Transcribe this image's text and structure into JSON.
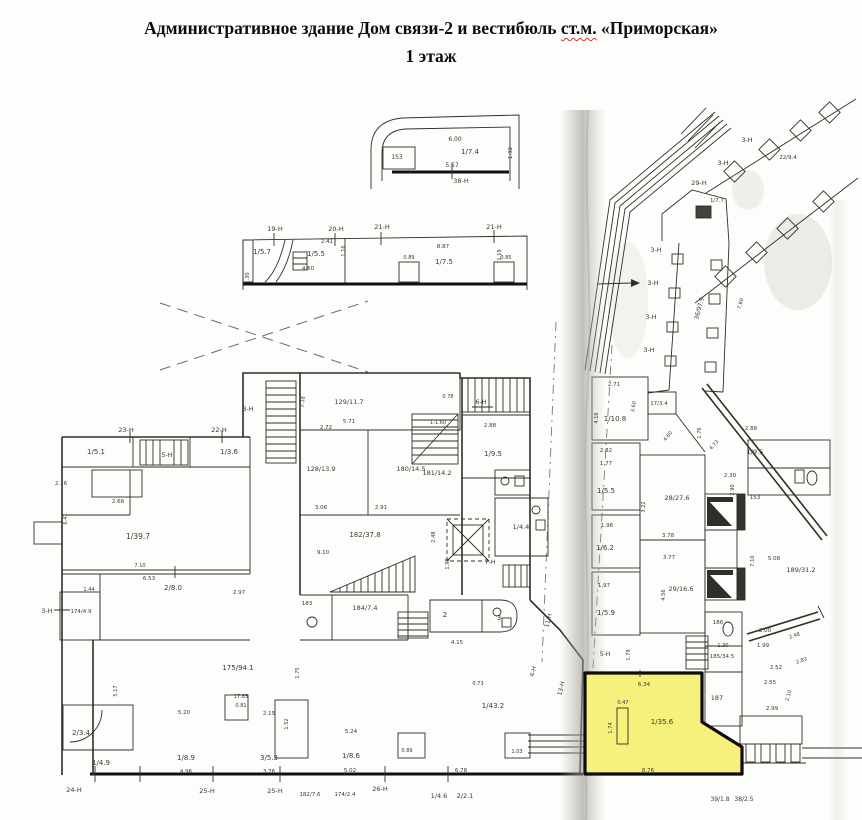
{
  "title": {
    "line1_pre": "Административное здание Дом связи-2 и вестибюль ",
    "line1_stm": "ст.м.",
    "line1_post": " «Приморская»",
    "line2": "1 этаж"
  },
  "colors": {
    "highlight": "#f7f07c",
    "ink": "#2f2e2a",
    "fold": "#aaa79f",
    "spell_underline": "#c4372e",
    "paper": "#fdfdfb"
  },
  "plan": {
    "highlight_room": {
      "room_label": "1/35.6",
      "top_dim": "6.34",
      "bottom_dim": "8.76"
    },
    "labels": [
      {
        "t": "6.00",
        "x": 455,
        "y": 141,
        "s": 6
      },
      {
        "t": "153",
        "x": 397,
        "y": 159,
        "s": 6
      },
      {
        "t": "1/7.4",
        "x": 470,
        "y": 154,
        "s": 7
      },
      {
        "t": "5.57",
        "x": 452,
        "y": 167,
        "s": 6
      },
      {
        "t": "38-Н",
        "x": 461,
        "y": 183,
        "s": 6.5
      },
      {
        "t": "1.92",
        "x": 512,
        "y": 153,
        "r": -90,
        "s": 5.5
      },
      {
        "t": "19-Н",
        "x": 275,
        "y": 231,
        "s": 6.5
      },
      {
        "t": "20-Н",
        "x": 336,
        "y": 231,
        "s": 6.5
      },
      {
        "t": "21-Н",
        "x": 382,
        "y": 229,
        "s": 6.5
      },
      {
        "t": "21-Н",
        "x": 494,
        "y": 229,
        "s": 6.5
      },
      {
        "t": "1/5.7",
        "x": 262,
        "y": 254,
        "s": 7
      },
      {
        "t": "2.41",
        "x": 327,
        "y": 243,
        "s": 5.5
      },
      {
        "t": "1/5.5",
        "x": 316,
        "y": 256,
        "s": 7
      },
      {
        "t": "1.16",
        "x": 345,
        "y": 251,
        "r": -90,
        "s": 5
      },
      {
        "t": "4.60",
        "x": 308,
        "y": 270,
        "s": 5.5
      },
      {
        "t": "1.30",
        "x": 249,
        "y": 278,
        "r": -90,
        "s": 5
      },
      {
        "t": "8.87",
        "x": 443,
        "y": 248,
        "s": 5.5
      },
      {
        "t": "1/7.5",
        "x": 444,
        "y": 264,
        "s": 7
      },
      {
        "t": "0.89",
        "x": 409,
        "y": 259,
        "s": 5
      },
      {
        "t": "0.85",
        "x": 506,
        "y": 259,
        "s": 5
      },
      {
        "t": "1.19",
        "x": 501,
        "y": 255,
        "r": -90,
        "s": 5
      },
      {
        "t": "23-Н",
        "x": 126,
        "y": 432,
        "s": 6.5
      },
      {
        "t": "22-Н",
        "x": 219,
        "y": 432,
        "s": 6.5
      },
      {
        "t": "1/5.1",
        "x": 96,
        "y": 454,
        "s": 7
      },
      {
        "t": "5-Н",
        "x": 167,
        "y": 457,
        "s": 6.5
      },
      {
        "t": "1/3.6",
        "x": 229,
        "y": 454,
        "s": 7
      },
      {
        "t": "2.16",
        "x": 61,
        "y": 485,
        "s": 5.5
      },
      {
        "t": "2.66",
        "x": 118,
        "y": 503,
        "s": 5.5
      },
      {
        "t": "6.41",
        "x": 67,
        "y": 519,
        "r": -90,
        "s": 5
      },
      {
        "t": "1/39.7",
        "x": 138,
        "y": 539,
        "s": 7.5
      },
      {
        "t": "7.10",
        "x": 140,
        "y": 567,
        "s": 5
      },
      {
        "t": "6.53",
        "x": 149,
        "y": 580,
        "s": 5.5
      },
      {
        "t": "1.44",
        "x": 89,
        "y": 591,
        "s": 5
      },
      {
        "t": "2/8.0",
        "x": 173,
        "y": 590,
        "s": 7
      },
      {
        "t": "174/4.9",
        "x": 81,
        "y": 613,
        "s": 5.5
      },
      {
        "t": "3-Н",
        "x": 47,
        "y": 613,
        "s": 6.5
      },
      {
        "t": "2.97",
        "x": 239,
        "y": 594,
        "s": 5.5
      },
      {
        "t": "5.17",
        "x": 117,
        "y": 691,
        "r": -90,
        "s": 5
      },
      {
        "t": "2/3.4",
        "x": 81,
        "y": 735,
        "s": 7
      },
      {
        "t": "1/4.9",
        "x": 101,
        "y": 765,
        "s": 7
      },
      {
        "t": "24-Н",
        "x": 74,
        "y": 792,
        "s": 6.5
      },
      {
        "t": "3-Н",
        "x": 248,
        "y": 411,
        "s": 6.5
      },
      {
        "t": "2.18",
        "x": 304,
        "y": 402,
        "r": -80,
        "s": 5
      },
      {
        "t": "129/11.7",
        "x": 349,
        "y": 404,
        "s": 6.5
      },
      {
        "t": "5.71",
        "x": 349,
        "y": 423,
        "s": 5.5
      },
      {
        "t": "0.78",
        "x": 448,
        "y": 398,
        "s": 5
      },
      {
        "t": "2.72",
        "x": 326,
        "y": 429,
        "s": 5.5
      },
      {
        "t": "128/13.9",
        "x": 321,
        "y": 471,
        "s": 6.5
      },
      {
        "t": "180/14.5",
        "x": 411,
        "y": 471,
        "s": 6.5
      },
      {
        "t": "1-1.60",
        "x": 438,
        "y": 424,
        "s": 5
      },
      {
        "t": "3.06",
        "x": 321,
        "y": 509,
        "s": 5.5
      },
      {
        "t": "2.91",
        "x": 381,
        "y": 509,
        "s": 5.5
      },
      {
        "t": "182/37.8",
        "x": 365,
        "y": 537,
        "s": 7
      },
      {
        "t": "9.10",
        "x": 323,
        "y": 554,
        "s": 5.5
      },
      {
        "t": "6-Н",
        "x": 481,
        "y": 404,
        "s": 6.5
      },
      {
        "t": "2.88",
        "x": 490,
        "y": 427,
        "s": 5.5
      },
      {
        "t": "1/9.5",
        "x": 493,
        "y": 456,
        "s": 7
      },
      {
        "t": "181/14.2",
        "x": 437,
        "y": 475,
        "s": 6.5
      },
      {
        "t": "2.48",
        "x": 435,
        "y": 537,
        "r": -90,
        "s": 5
      },
      {
        "t": "1/4.4",
        "x": 521,
        "y": 529,
        "s": 6.5
      },
      {
        "t": "7-Н",
        "x": 490,
        "y": 564,
        "s": 6.5
      },
      {
        "t": "1.98",
        "x": 449,
        "y": 564,
        "r": -90,
        "s": 5
      },
      {
        "t": "175/94.1",
        "x": 238,
        "y": 670,
        "s": 7
      },
      {
        "t": "1.75",
        "x": 299,
        "y": 673,
        "r": -90,
        "s": 5
      },
      {
        "t": "17.85",
        "x": 241,
        "y": 698,
        "s": 5
      },
      {
        "t": "0.81",
        "x": 241,
        "y": 707,
        "s": 5
      },
      {
        "t": "5.20",
        "x": 184,
        "y": 714,
        "s": 5.5
      },
      {
        "t": "2.15",
        "x": 269,
        "y": 715,
        "s": 5.5
      },
      {
        "t": "1.52",
        "x": 288,
        "y": 724,
        "r": -90,
        "s": 5
      },
      {
        "t": "1/8.9",
        "x": 186,
        "y": 760,
        "s": 7
      },
      {
        "t": "4.96",
        "x": 186,
        "y": 773,
        "s": 5.5
      },
      {
        "t": "3/5.3",
        "x": 269,
        "y": 760,
        "s": 7
      },
      {
        "t": "3.76",
        "x": 269,
        "y": 773,
        "s": 5.5
      },
      {
        "t": "5.24",
        "x": 351,
        "y": 733,
        "s": 5.5
      },
      {
        "t": "1/8.6",
        "x": 351,
        "y": 758,
        "s": 7
      },
      {
        "t": "5.02",
        "x": 350,
        "y": 772,
        "s": 5.5
      },
      {
        "t": "0.89",
        "x": 407,
        "y": 752,
        "s": 5
      },
      {
        "t": "6.78",
        "x": 461,
        "y": 772,
        "s": 5.5
      },
      {
        "t": "1.03",
        "x": 517,
        "y": 753,
        "s": 5
      },
      {
        "t": "183",
        "x": 307,
        "y": 605,
        "s": 5.5
      },
      {
        "t": "184/7.4",
        "x": 365,
        "y": 610,
        "s": 6.5
      },
      {
        "t": "2",
        "x": 445,
        "y": 617,
        "s": 7
      },
      {
        "t": "3",
        "x": 499,
        "y": 620,
        "s": 7
      },
      {
        "t": "4.15",
        "x": 457,
        "y": 644,
        "s": 5.5
      },
      {
        "t": "0.73",
        "x": 478,
        "y": 685,
        "s": 5
      },
      {
        "t": "1/43.2",
        "x": 493,
        "y": 708,
        "s": 7
      },
      {
        "t": "25-Н",
        "x": 207,
        "y": 793,
        "s": 6.5
      },
      {
        "t": "25-Н",
        "x": 275,
        "y": 793,
        "s": 6.5
      },
      {
        "t": "182/7.6",
        "x": 310,
        "y": 796,
        "s": 5.5
      },
      {
        "t": "174/2.4",
        "x": 345,
        "y": 796,
        "s": 5.5
      },
      {
        "t": "26-Н",
        "x": 380,
        "y": 791,
        "s": 6.5
      },
      {
        "t": "1/4.6",
        "x": 439,
        "y": 798,
        "s": 6.5
      },
      {
        "t": "2/2.1",
        "x": 465,
        "y": 798,
        "s": 6.5
      },
      {
        "t": "11-Н",
        "x": 550,
        "y": 621,
        "r": -75,
        "s": 6
      },
      {
        "t": "4-Н",
        "x": 535,
        "y": 672,
        "r": -75,
        "s": 6
      },
      {
        "t": "13-Н",
        "x": 563,
        "y": 689,
        "r": -75,
        "s": 6
      },
      {
        "t": "2.71",
        "x": 614,
        "y": 386,
        "s": 5.5
      },
      {
        "t": "3.60",
        "x": 635,
        "y": 407,
        "r": -80,
        "s": 5
      },
      {
        "t": "4.16",
        "x": 598,
        "y": 418,
        "r": -90,
        "s": 5
      },
      {
        "t": "1/10.8",
        "x": 615,
        "y": 421,
        "s": 7
      },
      {
        "t": "17/3.4",
        "x": 659,
        "y": 405,
        "s": 5.5
      },
      {
        "t": "4.60",
        "x": 669,
        "y": 437,
        "r": -50,
        "s": 5
      },
      {
        "t": "2.82",
        "x": 606,
        "y": 452,
        "s": 5.5
      },
      {
        "t": "1.77",
        "x": 606,
        "y": 465,
        "s": 5.5
      },
      {
        "t": "1/5.5",
        "x": 606,
        "y": 493,
        "s": 7
      },
      {
        "t": "3.22",
        "x": 645,
        "y": 507,
        "r": -90,
        "s": 5
      },
      {
        "t": "28/27.6",
        "x": 677,
        "y": 500,
        "s": 6.5
      },
      {
        "t": "1.96",
        "x": 607,
        "y": 527,
        "s": 5.5
      },
      {
        "t": "1/6.2",
        "x": 605,
        "y": 550,
        "s": 7
      },
      {
        "t": "3.78",
        "x": 668,
        "y": 537,
        "s": 5.5
      },
      {
        "t": "3.77",
        "x": 669,
        "y": 559,
        "s": 5.5
      },
      {
        "t": "1.97",
        "x": 604,
        "y": 587,
        "s": 5.5
      },
      {
        "t": "1/5.9",
        "x": 606,
        "y": 615,
        "s": 7
      },
      {
        "t": "4.56",
        "x": 665,
        "y": 595,
        "r": -90,
        "s": 5
      },
      {
        "t": "29/16.6",
        "x": 681,
        "y": 591,
        "s": 6.5
      },
      {
        "t": "1.76",
        "x": 701,
        "y": 433,
        "r": -90,
        "s": 5
      },
      {
        "t": "2.30",
        "x": 730,
        "y": 477,
        "s": 5.5
      },
      {
        "t": "153",
        "x": 755,
        "y": 499,
        "s": 5.5
      },
      {
        "t": "4.73",
        "x": 715,
        "y": 446,
        "r": -47,
        "s": 5
      },
      {
        "t": "2.88",
        "x": 751,
        "y": 430,
        "s": 5.5
      },
      {
        "t": "1/9.5",
        "x": 755,
        "y": 454,
        "s": 6.5
      },
      {
        "t": "2.90",
        "x": 734,
        "y": 490,
        "r": -90,
        "s": 5
      },
      {
        "t": "7.10",
        "x": 754,
        "y": 561,
        "r": -90,
        "s": 5
      },
      {
        "t": "5.08",
        "x": 774,
        "y": 560,
        "s": 5.5
      },
      {
        "t": "189/31.2",
        "x": 801,
        "y": 572,
        "s": 6.5
      },
      {
        "t": "29-Н",
        "x": 699,
        "y": 185,
        "s": 6.5
      },
      {
        "t": "1/7.7",
        "x": 717,
        "y": 202,
        "s": 5.5
      },
      {
        "t": "3-Н",
        "x": 723,
        "y": 165,
        "s": 6.5
      },
      {
        "t": "3-Н",
        "x": 747,
        "y": 142,
        "s": 6.5
      },
      {
        "t": "22/9.4",
        "x": 788,
        "y": 159,
        "s": 5.5
      },
      {
        "t": "3-Н",
        "x": 656,
        "y": 252,
        "s": 6.5
      },
      {
        "t": "3-Н",
        "x": 653,
        "y": 285,
        "s": 6.5
      },
      {
        "t": "3-Н",
        "x": 651,
        "y": 319,
        "s": 6.5
      },
      {
        "t": "3-Н",
        "x": 649,
        "y": 352,
        "s": 6.5
      },
      {
        "t": "36/97.9",
        "x": 701,
        "y": 309,
        "r": -75,
        "s": 6
      },
      {
        "t": "7.60",
        "x": 742,
        "y": 304,
        "r": -75,
        "s": 5
      },
      {
        "t": "186",
        "x": 718,
        "y": 624,
        "s": 5.5
      },
      {
        "t": "1.30",
        "x": 723,
        "y": 647,
        "s": 5
      },
      {
        "t": "185/34.5",
        "x": 722,
        "y": 658,
        "s": 5.5
      },
      {
        "t": "187",
        "x": 717,
        "y": 700,
        "s": 6.5
      },
      {
        "t": "2.00",
        "x": 765,
        "y": 632,
        "s": 5.5
      },
      {
        "t": "1.99",
        "x": 763,
        "y": 647,
        "s": 5.5
      },
      {
        "t": "2.48",
        "x": 795,
        "y": 637,
        "r": -20,
        "s": 5
      },
      {
        "t": "2.52",
        "x": 776,
        "y": 669,
        "s": 5.5
      },
      {
        "t": "2.55",
        "x": 770,
        "y": 684,
        "s": 5.5
      },
      {
        "t": "2.83",
        "x": 802,
        "y": 662,
        "r": -20,
        "s": 5
      },
      {
        "t": "2.99",
        "x": 772,
        "y": 710,
        "s": 5.5
      },
      {
        "t": "2.10",
        "x": 790,
        "y": 696,
        "r": -75,
        "s": 5
      },
      {
        "t": "5-Н",
        "x": 605,
        "y": 656,
        "s": 6
      },
      {
        "t": "1.79",
        "x": 630,
        "y": 655,
        "r": -90,
        "s": 5
      },
      {
        "t": "6.34",
        "x": 644,
        "y": 686,
        "s": 5.5
      },
      {
        "t": "0.47",
        "x": 623,
        "y": 704,
        "s": 5
      },
      {
        "t": "1.74",
        "x": 612,
        "y": 728,
        "r": -90,
        "s": 5
      },
      {
        "t": "1/35.6",
        "x": 662,
        "y": 724,
        "s": 7
      },
      {
        "t": "8.76",
        "x": 648,
        "y": 772,
        "s": 5.5
      },
      {
        "t": "39/1.8",
        "x": 720,
        "y": 801,
        "s": 6
      },
      {
        "t": "38/2.5",
        "x": 744,
        "y": 801,
        "s": 6
      }
    ]
  }
}
